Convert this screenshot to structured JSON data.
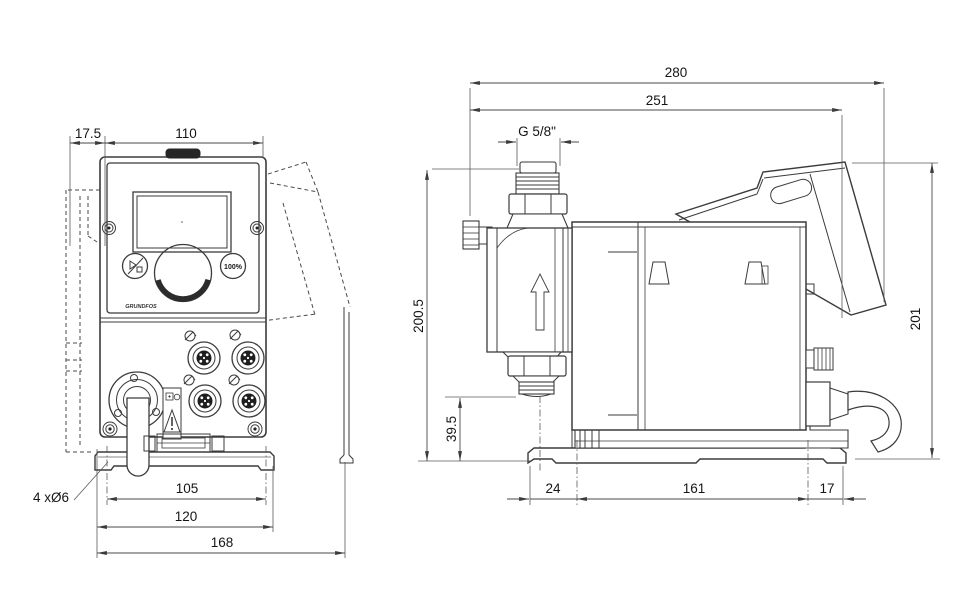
{
  "front": {
    "dim_offset": "17.5",
    "dim_width_top": "110",
    "dim_hole_spacing": "105",
    "dim_plate_width": "120",
    "dim_overall_width": "168",
    "label_holes": "4 xØ6",
    "button_100_label": "100%",
    "logo_text": "GRUNDFOS"
  },
  "side": {
    "dim_overall_length": "280",
    "dim_length_to_hood": "251",
    "label_thread": "G 5/8\"",
    "dim_height_total": "200.5",
    "dim_suction_height": "39.5",
    "dim_height_right": "201",
    "dim_foot_left": "24",
    "dim_foot_center": "161",
    "dim_foot_right": "17"
  },
  "colors": {
    "background": "#ffffff",
    "line": "#3b3b3b",
    "dimension": "#4a4a4a",
    "text": "#151515"
  }
}
